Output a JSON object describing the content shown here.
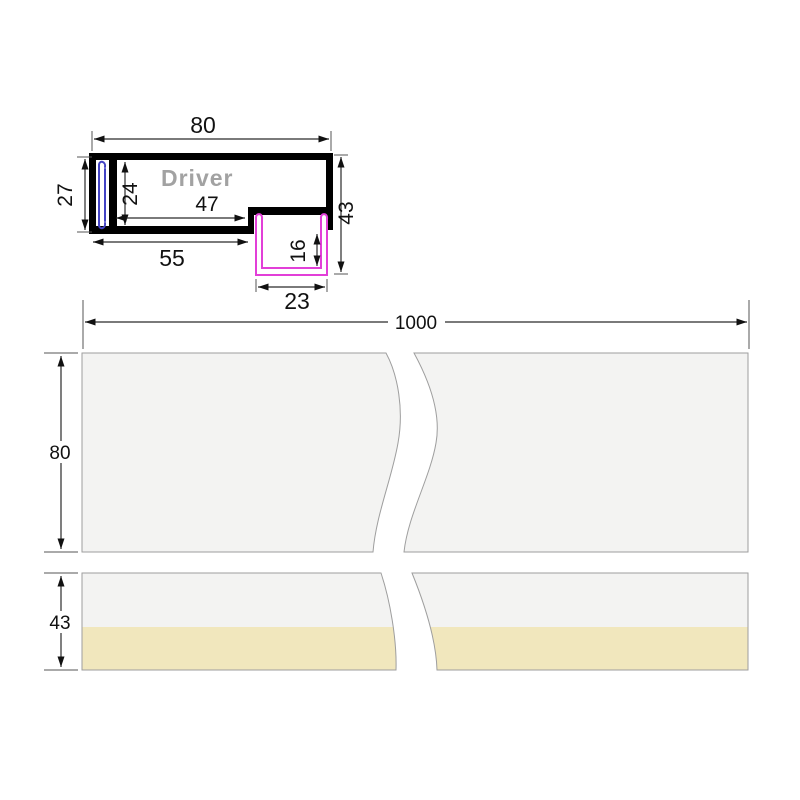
{
  "cross_section": {
    "driver_label": "Driver",
    "dims": {
      "top_width": "80",
      "left_height": "27",
      "cavity_height": "24",
      "cavity_width": "47",
      "bottom_width": "55",
      "total_height": "43",
      "channel_depth": "16",
      "channel_width": "23"
    }
  },
  "length_view": {
    "length": "1000",
    "upper_profile_height": "80",
    "lower_profile_height": "43"
  },
  "colors": {
    "outline_black": "#000000",
    "led_channel_pink": "#e23fd8",
    "clip_channel_blue": "#4343c4",
    "driver_text_gray": "#a2a2a2",
    "bar_fill_gray": "#f3f3f2",
    "bar_border_gray": "#9e9e9e",
    "diffuser_yellow": "#f1e7bd"
  }
}
